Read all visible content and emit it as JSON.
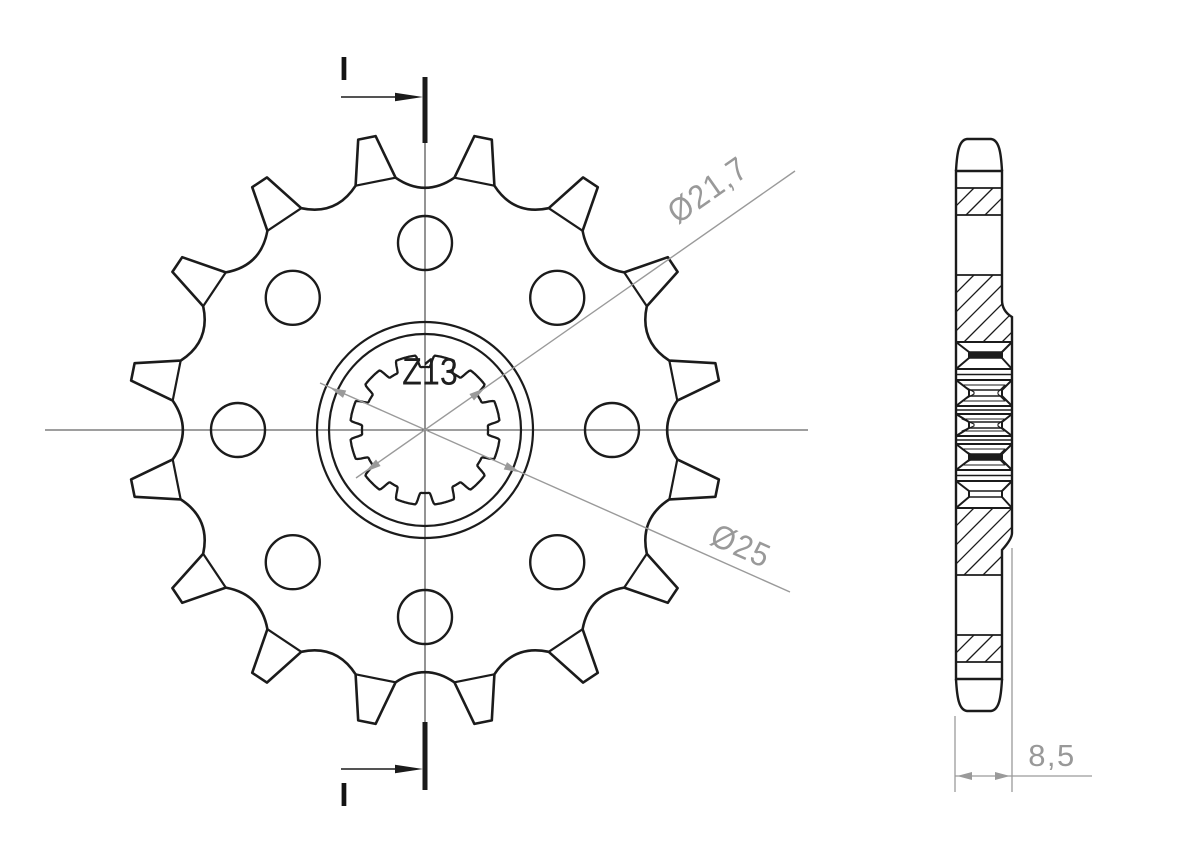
{
  "drawing": {
    "background_color": "#ffffff",
    "line_color": "#1b1b1b",
    "centerline_color": "#3c3c3c",
    "dim_color": "#9a9a9a",
    "front_view": {
      "teeth_shown": 16,
      "bolt_holes_shown": 8,
      "spline_teeth_shown": 12,
      "teeth_count_label": "Z13",
      "bore_diameter_label": "Ø21,7",
      "hub_diameter_label": "Ø25",
      "section_marker_top": "I",
      "section_marker_bottom": "I"
    },
    "side_view": {
      "width_label": "8,5"
    }
  }
}
